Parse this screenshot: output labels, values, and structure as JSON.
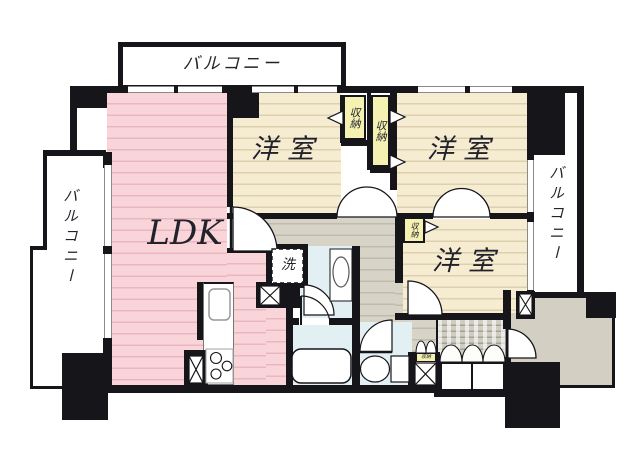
{
  "title": "マンション間取り図",
  "labels": {
    "balcony_top": "バルコニー",
    "balcony_left": "バルコニー",
    "balcony_right": "バルコニー",
    "ldk": "LDK",
    "bedroom_a": "洋室",
    "bedroom_b": "洋室",
    "bedroom_c": "洋室",
    "closet_a": "収納",
    "closet_b": "収納",
    "closet_c": "収納",
    "closet_d": "収納",
    "closet_e": "収納",
    "laundry": "洗"
  },
  "colors": {
    "wall": "#15151a",
    "ldk_floor": "#f9d5da",
    "bedroom_floor": "#f6ecd2",
    "closet_fill": "#f4f1b2",
    "hallway_floor": "#d7d4c7",
    "wet_area_floor": "#e2eff3",
    "porch_floor": "#d3d0c3",
    "balcony": "#ffffff"
  }
}
